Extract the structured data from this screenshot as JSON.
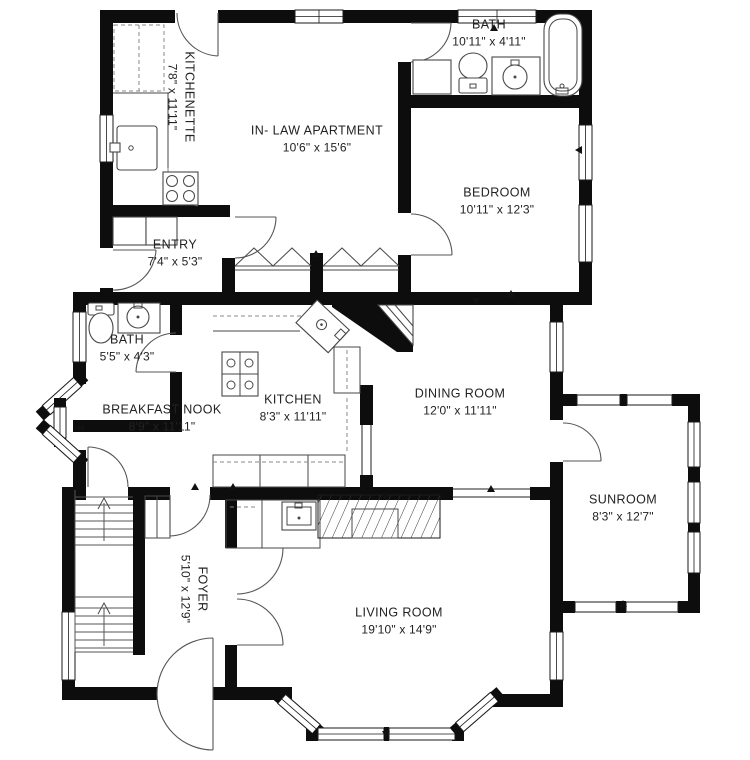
{
  "title": "Floor plan",
  "colors": {
    "wall": "#0d0d0d",
    "background": "#ffffff",
    "fixture_line": "#474747"
  },
  "rooms": [
    {
      "id": "kitchenette",
      "name": "KITCHENETTE",
      "dims": "7'8\" x 11'11\""
    },
    {
      "id": "inlaw_apartment",
      "name": "IN- LAW APARTMENT",
      "dims": "10'6\" x 15'6\""
    },
    {
      "id": "bath_upper",
      "name": "BATH",
      "dims": "10'11\" x 4'11\""
    },
    {
      "id": "bedroom",
      "name": "BEDROOM",
      "dims": "10'11\" x 12'3\""
    },
    {
      "id": "entry",
      "name": "ENTRY",
      "dims": "7'4\" x 5'3\""
    },
    {
      "id": "bath_small",
      "name": "BATH",
      "dims": "5'5\" x 4'3\""
    },
    {
      "id": "breakfast_nook",
      "name": "BREAKFAST NOOK",
      "dims": "8'9\" x 11'11\""
    },
    {
      "id": "kitchen",
      "name": "KITCHEN",
      "dims": "8'3\" x 11'11\""
    },
    {
      "id": "dining_room",
      "name": "DINING ROOM",
      "dims": "12'0\" x 11'11\""
    },
    {
      "id": "sunroom",
      "name": "SUNROOM",
      "dims": "8'3\" x 12'7\""
    },
    {
      "id": "foyer",
      "name": "FOYER",
      "dims": "5'10\" x 12'9\""
    },
    {
      "id": "living_room",
      "name": "LIVING ROOM",
      "dims": "19'10\" x 14'9\""
    }
  ]
}
